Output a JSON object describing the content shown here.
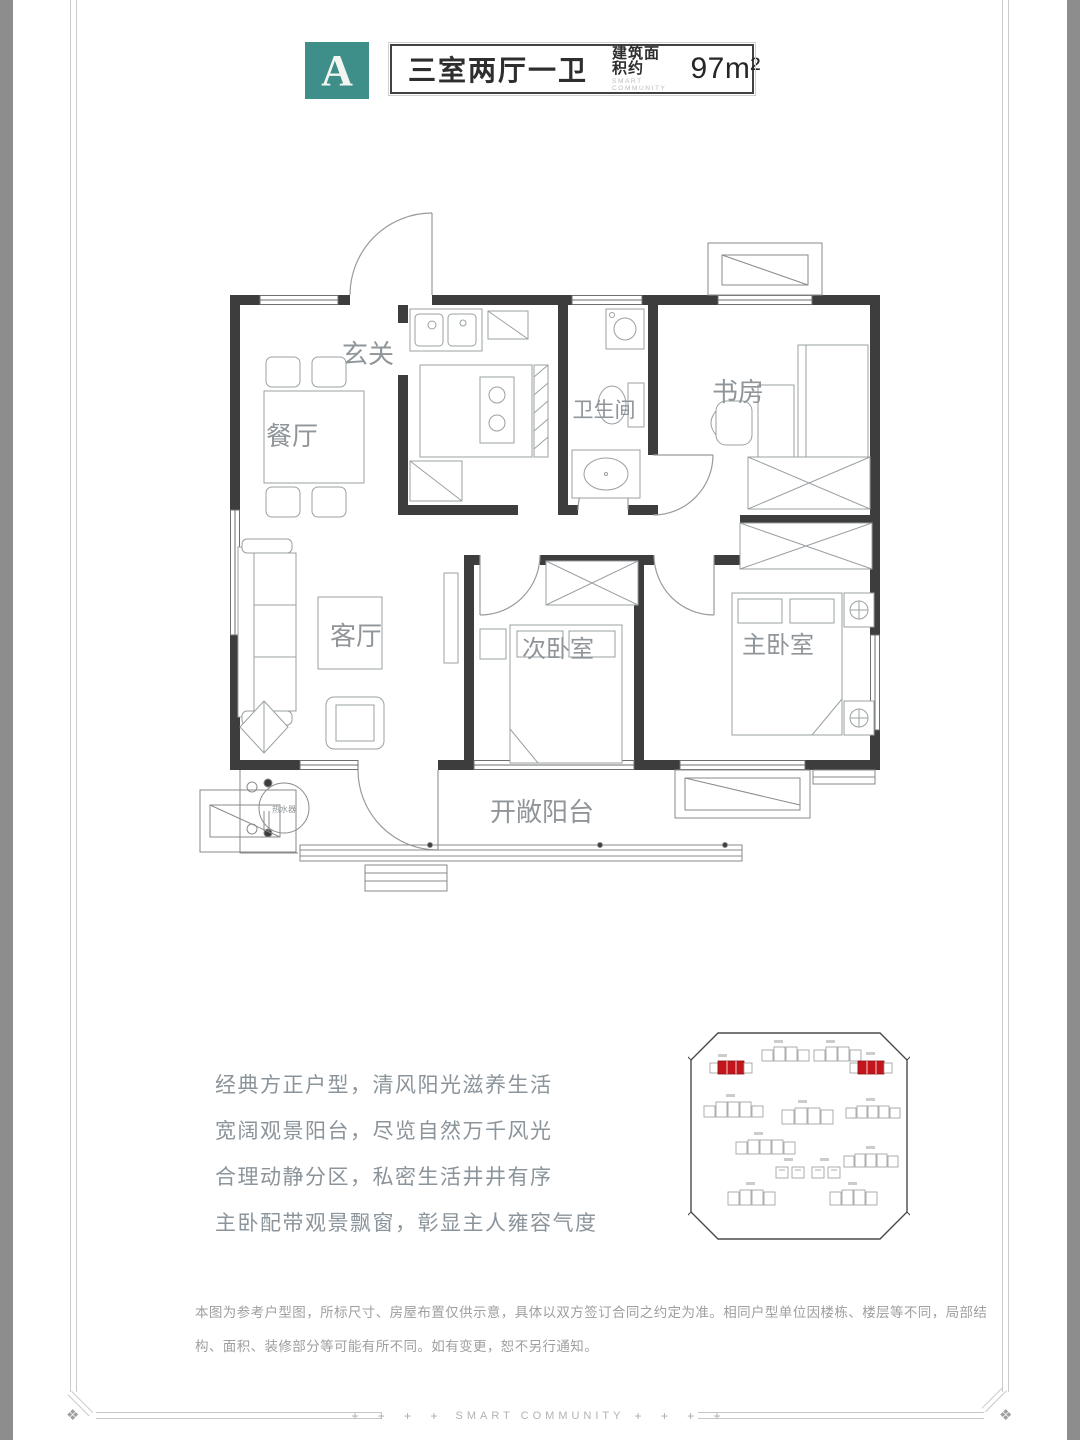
{
  "header": {
    "unit_badge": "A",
    "unit_type": "三室两厅一卫",
    "area_label": "建筑面积约",
    "area_sublabel": "SMART COMMUNITY",
    "area_value": "97m²"
  },
  "floor_plan": {
    "rooms": {
      "entry": "玄关",
      "dining": "餐厅",
      "bathroom": "卫生间",
      "study": "书房",
      "living": "客厅",
      "second_bedroom": "次卧室",
      "master_bedroom": "主卧室",
      "balcony": "开敞阳台",
      "water_heater": "热水器"
    }
  },
  "description": {
    "lines": [
      "经典方正户型，清风阳光滋养生活",
      "宽阔观景阳台，尽览自然万千风光",
      "合理动静分区，私密生活井井有序",
      "主卧配带观景飘窗，彰显主人雍容气度"
    ]
  },
  "site_plan": {
    "highlighted_building_count": 2,
    "highlight_color": "#C3161C"
  },
  "disclaimer": "本图为参考户型图，所标尺寸、房屋布置仅供示意，具体以双方签订合同之约定为准。相同户型单位因楼栋、楼层等不同，局部结构、面积、装修部分等可能有所不同。如有变更，恕不另行通知。",
  "footer": {
    "plus_left": "+ + + +",
    "brand": "SMART COMMUNITY",
    "plus_right": "+ + + +"
  },
  "colors": {
    "badge_teal": "#3E8E8A",
    "wall_dark": "#3D3D3D",
    "frame_gray": "#8D8D8D"
  }
}
